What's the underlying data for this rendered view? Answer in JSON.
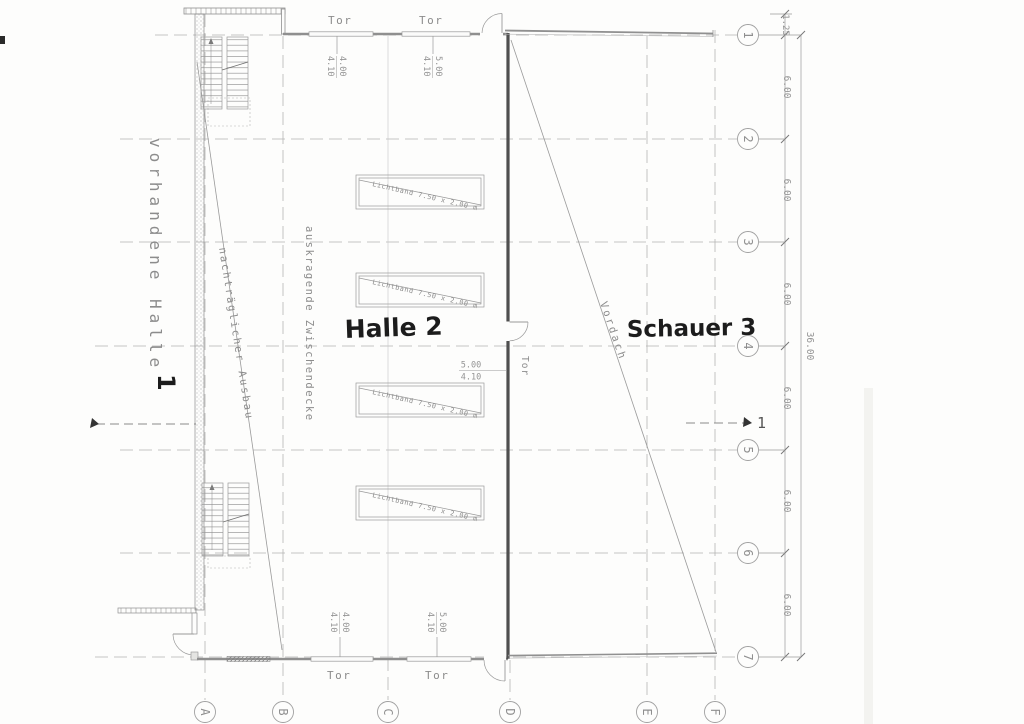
{
  "labels": {
    "existing_hall": "vorhandene Halle",
    "existing_hall_no": "1",
    "extension_diag": "nachträglicher Ausbau",
    "cantilever_deck": "auskragende Zwischendecke",
    "hall2": "Halle 2",
    "shed3": "Schauer 3",
    "canopy": "Vordach",
    "gate": "Tor",
    "skylight": "Lichtband  7.50 x 2.00 m",
    "section_no": "1"
  },
  "dimensions": {
    "bay": "6.00",
    "total": "36.00",
    "offset": "1.25",
    "gate_a_w": "4.00",
    "gate_a_h": "4.10",
    "gate_b_w": "5.00",
    "gate_b_h": "4.10"
  },
  "grid": {
    "rows": [
      "1",
      "2",
      "3",
      "4",
      "5",
      "6",
      "7"
    ],
    "cols": [
      "A",
      "B",
      "C",
      "D",
      "E",
      "F"
    ]
  },
  "colors": {
    "paper": "#fdfdfc",
    "wall_dark": "#4f4f4f",
    "line": "#8f8f8f",
    "handwriting": "#1c1c1c"
  }
}
